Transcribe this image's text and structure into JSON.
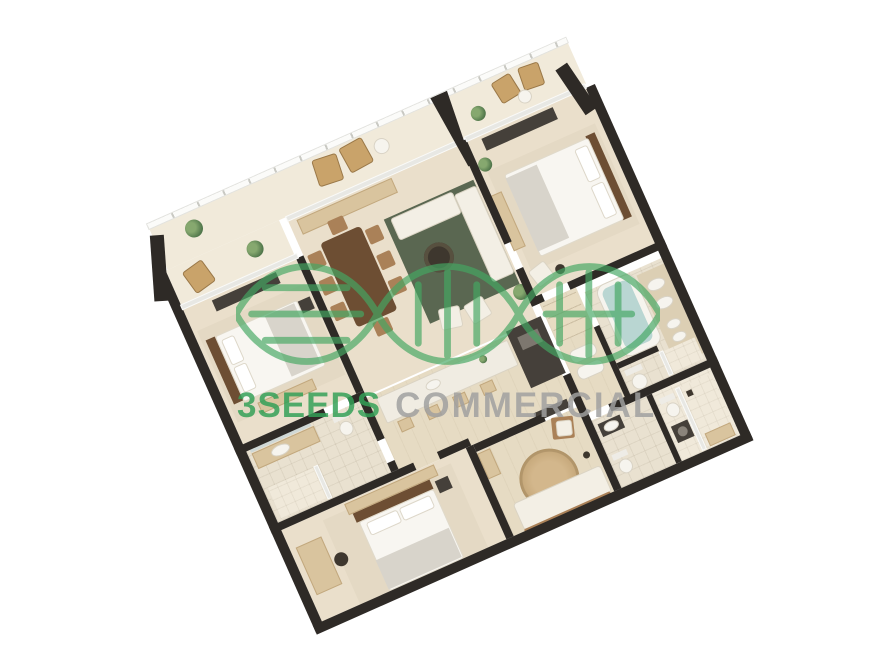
{
  "page": {
    "background": "#FFFFFF"
  },
  "watermark": {
    "brand": "3SEEDS",
    "suffix": "COMMERCIAL",
    "brand_color": "#33A057",
    "suffix_color": "#A0A0A0",
    "logo": "dna-helix-logo",
    "logo_color": "#45A863"
  },
  "palette": {
    "wall": "#2E2A26",
    "floor": "#EADFCB",
    "floor_tile": "#E9E1D0",
    "balcony_floor": "#F1EADA",
    "rug_green": "#5A6751",
    "rug_beige": "#E4D9C4",
    "rug_round": "#CBAE82",
    "wood_dark": "#6D4E33",
    "wood_mid": "#AA8158",
    "wood_light": "#D9C49E",
    "bed_linen": "#F8F6F1",
    "blanket_gray": "#D8D4CB",
    "tub_teal": "#B9D6D2",
    "appliance_dark": "#45403A",
    "glass_rail": "#E8E8E4",
    "brand_green": "#33A057",
    "helix_green": "#45A863",
    "suffix_gray": "#A0A0A0"
  }
}
